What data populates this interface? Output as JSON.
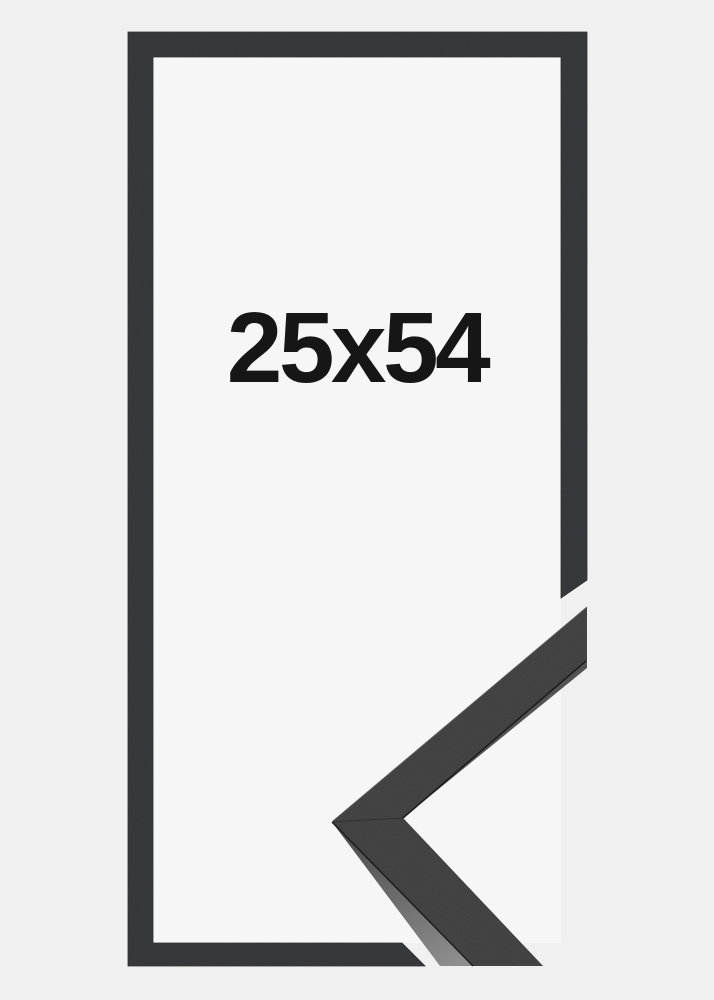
{
  "product": {
    "size_label": "25x54"
  },
  "frame": {
    "colors": {
      "background": "#f0f0f0",
      "opening": "#f6f6f6",
      "frame": "#333437",
      "moulding_face": "#3d3d3e",
      "moulding_side_dark": "#4a4a4a",
      "moulding_side_light": "#8c8c8c",
      "edge_line": "#1d1d1d",
      "label_text": "#161616"
    }
  }
}
